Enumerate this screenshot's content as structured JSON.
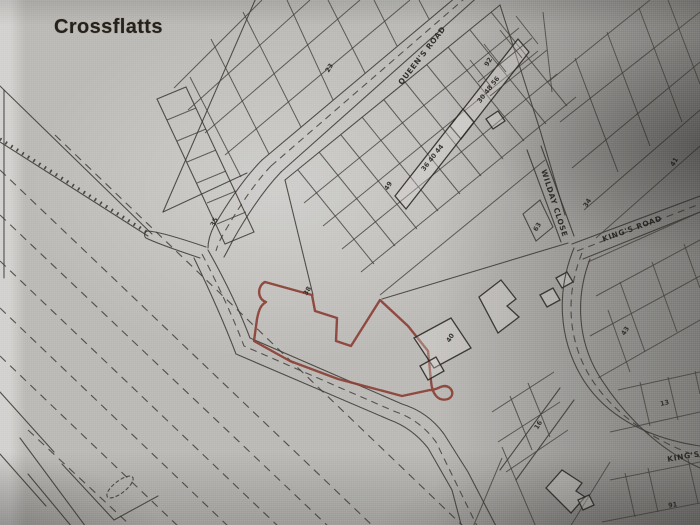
{
  "title": "Crossflatts",
  "map": {
    "colors": {
      "site_boundary": "#8a4137",
      "line": "#3b3833"
    },
    "road_labels": [
      {
        "id": "queens-road",
        "text": "QUEEN'S ROAD",
        "x": 424,
        "y": 57,
        "rot": -52
      },
      {
        "id": "wilday-close",
        "text": "WILDAY CLOSE",
        "x": 552,
        "y": 204,
        "rot": 72
      },
      {
        "id": "kings-road",
        "text": "KING'S ROAD",
        "x": 633,
        "y": 231,
        "rot": -20
      },
      {
        "id": "kings-road-lower",
        "text": "KING'S",
        "x": 684,
        "y": 459,
        "rot": -10
      }
    ],
    "plot_numbers": [
      {
        "text": "23",
        "x": 331,
        "y": 69,
        "rot": -58
      },
      {
        "text": "92",
        "x": 490,
        "y": 63,
        "rot": -58
      },
      {
        "text": "30 48 56",
        "x": 490,
        "y": 91,
        "rot": -52
      },
      {
        "text": "36 40 44",
        "x": 434,
        "y": 159,
        "rot": -52
      },
      {
        "text": "49",
        "x": 390,
        "y": 187,
        "rot": -58
      },
      {
        "text": "35",
        "x": 216,
        "y": 223,
        "rot": -62
      },
      {
        "text": "38",
        "x": 309,
        "y": 292,
        "rot": -58
      },
      {
        "text": "40",
        "x": 452,
        "y": 339,
        "rot": -58
      },
      {
        "text": "34",
        "x": 589,
        "y": 204,
        "rot": -58
      },
      {
        "text": "63",
        "x": 539,
        "y": 228,
        "rot": -58
      },
      {
        "text": "41",
        "x": 676,
        "y": 163,
        "rot": -58
      },
      {
        "text": "43",
        "x": 627,
        "y": 332,
        "rot": -58
      },
      {
        "text": "13",
        "x": 665,
        "y": 405,
        "rot": -12
      },
      {
        "text": "16",
        "x": 540,
        "y": 426,
        "rot": -58
      },
      {
        "text": "91",
        "x": 673,
        "y": 507,
        "rot": -8
      }
    ]
  }
}
